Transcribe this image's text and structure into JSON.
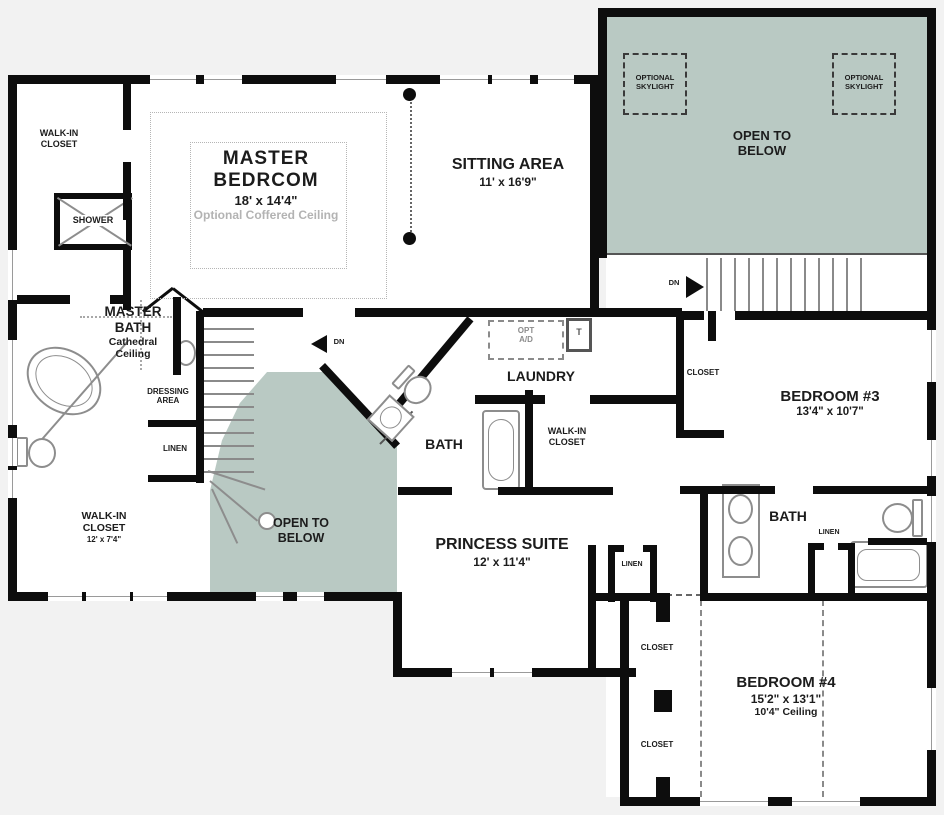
{
  "colors": {
    "background": "#f2f2f2",
    "wall": "#0d0d0d",
    "open_to_below_fill": "#b9c9c3",
    "fixture_stroke": "#8d8d8d",
    "text": "#1c1c1c",
    "muted_note": "#b3b3b3"
  },
  "labels": {
    "wic_tl": {
      "l1": "WALK-IN",
      "l2": "CLOSET"
    },
    "shower": "SHOWER",
    "master_bedroom": {
      "l1": "MASTER",
      "l2": "BEDRCOM",
      "dims": "18' x 14'4\"",
      "note": "Optional Coffered Ceiling"
    },
    "sitting": {
      "name": "SITTING AREA",
      "dims": "11' x 16'9\""
    },
    "open_below": {
      "l1": "OPEN TO",
      "l2": "BELOW"
    },
    "skylight": {
      "l1": "OPTIONAL",
      "l2": "SKYLIGHT"
    },
    "master_bath": {
      "l1": "MASTER",
      "l2": "BATH",
      "l3": "Cathedral",
      "l4": "Ceiling"
    },
    "dressing": {
      "l1": "DRESSING",
      "l2": "AREA"
    },
    "linen": "LINEN",
    "dn": "DN",
    "wic_bl": {
      "l1": "WALK-IN",
      "l2": "CLOSET",
      "dims": "12' x 7'4\""
    },
    "laundry": "LAUNDRY",
    "opt_box": {
      "l1": "OPT",
      "l2": "A/D"
    },
    "tub_box": "T",
    "bath": "BATH",
    "wic_princess": {
      "l1": "WALK-IN",
      "l2": "CLOSET"
    },
    "princess": {
      "name": "PRINCESS SUITE",
      "dims": "12' x 11'4\""
    },
    "bedroom3": {
      "name": "BEDROOM #3",
      "dims": "13'4\" x 10'7\""
    },
    "closet": "CLOSET",
    "bedroom4": {
      "name": "BEDROOM #4",
      "dims": "15'2\" x 13'1\"",
      "ceiling": "10'4\" Ceiling"
    }
  }
}
